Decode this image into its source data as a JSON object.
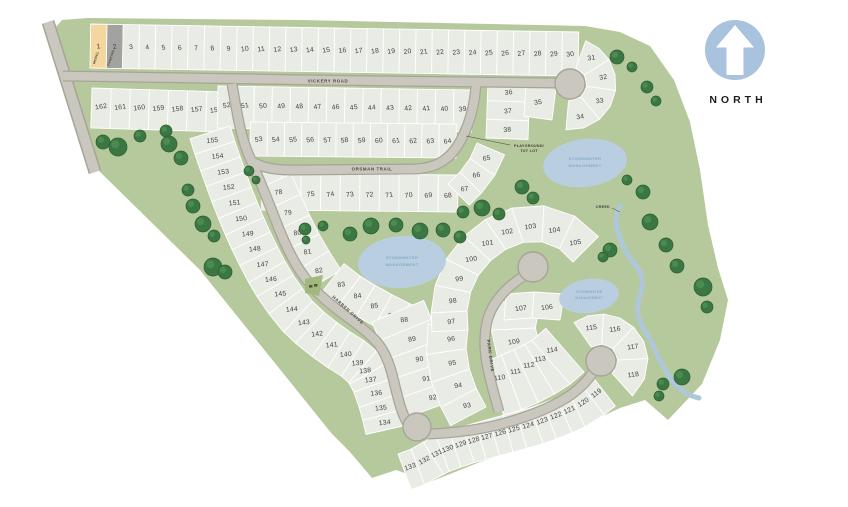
{
  "north": {
    "label": "NORTH"
  },
  "roads": {
    "vickery": "VICKERY ROAD",
    "orsman": "ORSMAN TRAIL",
    "harben": "HARBEN DRIVE",
    "park": "PARK DRIVE"
  },
  "labels": {
    "stormwater": [
      "STORMWATER",
      "MANAGEMENT"
    ],
    "creek": "CREEK",
    "playground": [
      "PLAYGROUND/",
      "TOT LOT"
    ]
  },
  "special_lots": {
    "model": {
      "lot": "1",
      "tag": "MODEL"
    },
    "parking": {
      "lot": "2",
      "tag": "PARKING"
    }
  },
  "lot_rows": {
    "top_row": [
      1,
      2,
      3,
      4,
      5,
      6,
      7,
      8,
      9,
      10,
      11,
      12,
      13,
      14,
      15,
      16,
      17,
      18,
      19,
      20,
      21,
      22,
      23,
      24,
      25,
      26,
      27,
      28,
      29,
      30
    ],
    "row_156_162": [
      162,
      161,
      160,
      159,
      158,
      157,
      156
    ],
    "row_39_52": [
      52,
      51,
      50,
      49,
      48,
      47,
      46,
      45,
      44,
      43,
      42,
      41,
      40,
      39
    ],
    "stack_36_38": [
      36,
      37,
      38
    ],
    "row_53_64": [
      53,
      54,
      55,
      56,
      57,
      58,
      59,
      60,
      61,
      62,
      63,
      64
    ],
    "row_68_77": [
      77,
      76,
      75,
      74,
      73,
      72,
      71,
      70,
      69,
      68
    ],
    "fan_65_67": [
      67,
      66,
      65
    ],
    "col_78_82": [
      78,
      79,
      80,
      81,
      82
    ],
    "row_83_87": [
      83,
      84,
      85,
      86,
      87
    ],
    "col_88_92": [
      88,
      89,
      90,
      91,
      92
    ],
    "col_93_96": [
      96,
      95,
      94,
      93
    ],
    "arc_97_105": [
      97,
      98,
      99,
      100,
      101,
      102,
      103,
      104,
      105
    ],
    "blk_108_109": [
      108,
      109
    ],
    "row_110_114": [
      110,
      111,
      112,
      113,
      114
    ],
    "row_119_133": [
      119,
      120,
      121,
      122,
      123,
      124,
      125,
      126,
      127,
      128,
      129,
      130,
      131,
      132,
      133
    ],
    "col_134_155": [
      155,
      154,
      153,
      152,
      151,
      150,
      149,
      148,
      147,
      146,
      145,
      144,
      143,
      142,
      141,
      140,
      139,
      138,
      137,
      136,
      135,
      134
    ]
  },
  "lot_fans": {
    "fan_31_34": [
      31,
      32,
      33,
      34
    ],
    "fan_115_118": [
      115,
      116,
      117,
      118
    ]
  },
  "lot_singles": {
    "lot_35": "35",
    "lot_106": "106",
    "lot_107": "107"
  },
  "colors": {
    "green": "#b6c99c",
    "lot": "#e9ebe5",
    "lot_model": "#f4d7a0",
    "lot_parking": "#a2a2a0",
    "road": "#cac7be",
    "road_edge": "#a7a499",
    "water": "#b9cfe1",
    "water_text": "#84a9c5",
    "tree": "#3a7742",
    "tree_edge": "#2c5e34",
    "north_blue": "#a9c2dd",
    "lot_text": "#434341"
  },
  "trees": [
    [
      103,
      142,
      7
    ],
    [
      118,
      147,
      9
    ],
    [
      140,
      136,
      6
    ],
    [
      166,
      131,
      6
    ],
    [
      169,
      144,
      8
    ],
    [
      181,
      158,
      7
    ],
    [
      188,
      190,
      6
    ],
    [
      193,
      206,
      7
    ],
    [
      203,
      224,
      8
    ],
    [
      214,
      236,
      6
    ],
    [
      213,
      267,
      9
    ],
    [
      225,
      272,
      7
    ],
    [
      305,
      229,
      6
    ],
    [
      323,
      226,
      5
    ],
    [
      350,
      234,
      7
    ],
    [
      371,
      226,
      8
    ],
    [
      396,
      225,
      7
    ],
    [
      420,
      231,
      8
    ],
    [
      443,
      230,
      7
    ],
    [
      460,
      237,
      6
    ],
    [
      306,
      240,
      4
    ],
    [
      463,
      212,
      6
    ],
    [
      482,
      208,
      8
    ],
    [
      499,
      214,
      6
    ],
    [
      522,
      187,
      7
    ],
    [
      533,
      198,
      6
    ],
    [
      617,
      57,
      7
    ],
    [
      632,
      67,
      5
    ],
    [
      647,
      87,
      6
    ],
    [
      656,
      101,
      5
    ],
    [
      627,
      180,
      5
    ],
    [
      643,
      192,
      7
    ],
    [
      650,
      222,
      8
    ],
    [
      610,
      250,
      7
    ],
    [
      603,
      257,
      5
    ],
    [
      666,
      245,
      7
    ],
    [
      677,
      266,
      7
    ],
    [
      703,
      287,
      9
    ],
    [
      707,
      307,
      6
    ],
    [
      682,
      377,
      8
    ],
    [
      663,
      384,
      6
    ],
    [
      659,
      396,
      5
    ],
    [
      249,
      171,
      5
    ],
    [
      256,
      180,
      4
    ]
  ]
}
